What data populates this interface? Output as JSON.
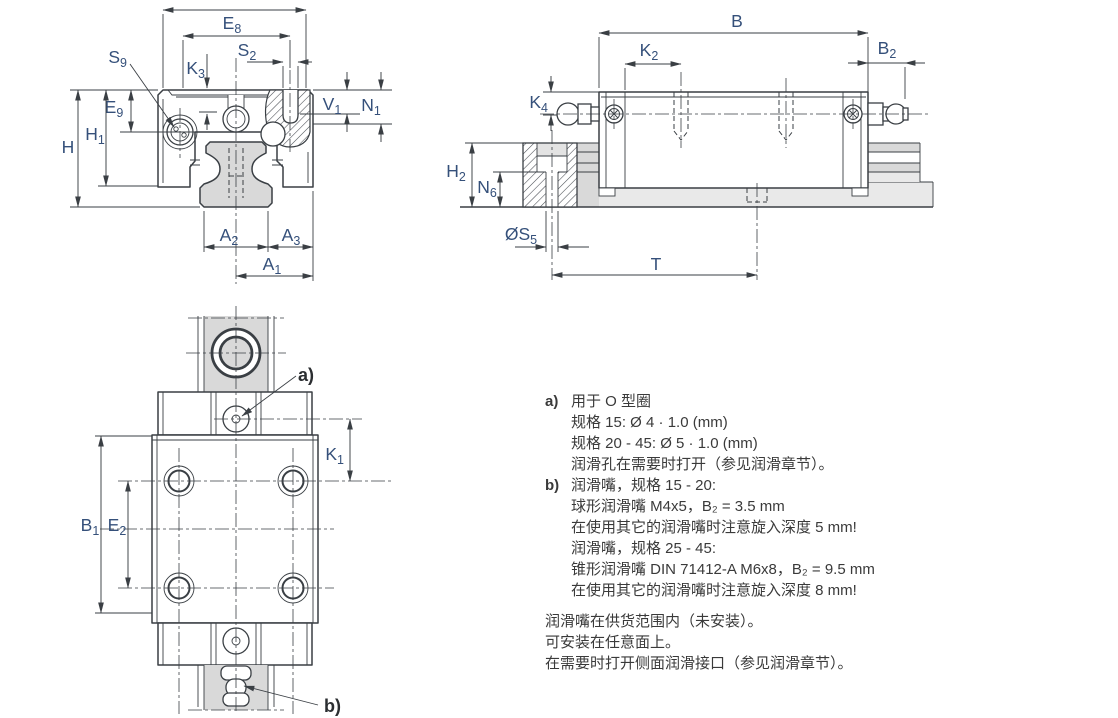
{
  "dims": {
    "e8": {
      "b": "E",
      "s": "8"
    },
    "s2": {
      "b": "S",
      "s": "2"
    },
    "s9": {
      "b": "S",
      "s": "9"
    },
    "k3": {
      "b": "K",
      "s": "3"
    },
    "e9": {
      "b": "E",
      "s": "9"
    },
    "h": {
      "b": "H",
      "s": ""
    },
    "h1": {
      "b": "H",
      "s": "1"
    },
    "v1": {
      "b": "V",
      "s": "1"
    },
    "n1": {
      "b": "N",
      "s": "1"
    },
    "a2": {
      "b": "A",
      "s": "2"
    },
    "a3": {
      "b": "A",
      "s": "3"
    },
    "a1": {
      "b": "A",
      "s": "1"
    },
    "b": {
      "b": "B",
      "s": ""
    },
    "k2": {
      "b": "K",
      "s": "2"
    },
    "b2": {
      "b": "B",
      "s": "2"
    },
    "k4": {
      "b": "K",
      "s": "4"
    },
    "h2": {
      "b": "H",
      "s": "2"
    },
    "n6": {
      "b": "N",
      "s": "6"
    },
    "s5": {
      "b": "ØS",
      "s": "5"
    },
    "t": {
      "b": "T",
      "s": ""
    },
    "k1": {
      "b": "K",
      "s": "1"
    },
    "b1": {
      "b": "B",
      "s": "1"
    },
    "e2": {
      "b": "E",
      "s": "2"
    }
  },
  "refs": {
    "a": "a)",
    "b": "b)"
  },
  "notes": {
    "a_prefix": "a)",
    "a_lines": [
      "用于 O 型圈",
      "规格 15: Ø 4 · 1.0 (mm)",
      "规格 20 - 45: Ø 5 · 1.0 (mm)",
      "润滑孔在需要时打开（参见润滑章节）。"
    ],
    "b_prefix": "b)",
    "b_lines": [
      "润滑嘴，规格 15 - 20:",
      "球形润滑嘴 M4x5，B₂ = 3.5 mm",
      "在使用其它的润滑嘴时注意旋入深度 5 mm!",
      "润滑嘴，规格 25 - 45:",
      "锥形润滑嘴 DIN 71412-A M6x8，B₂ = 9.5 mm",
      "在使用其它的润滑嘴时注意旋入深度 8 mm!"
    ],
    "footer": [
      "润滑嘴在供货范围内（未安装）。",
      "可安装在任意面上。",
      "在需要时打开侧面润滑接口（参见润滑章节）。"
    ]
  },
  "colors": {
    "line": "#3a3f44",
    "label": "#35507a",
    "rail_fill": "#d9d9d9",
    "rail_fill_light": "#e9e9e9"
  }
}
